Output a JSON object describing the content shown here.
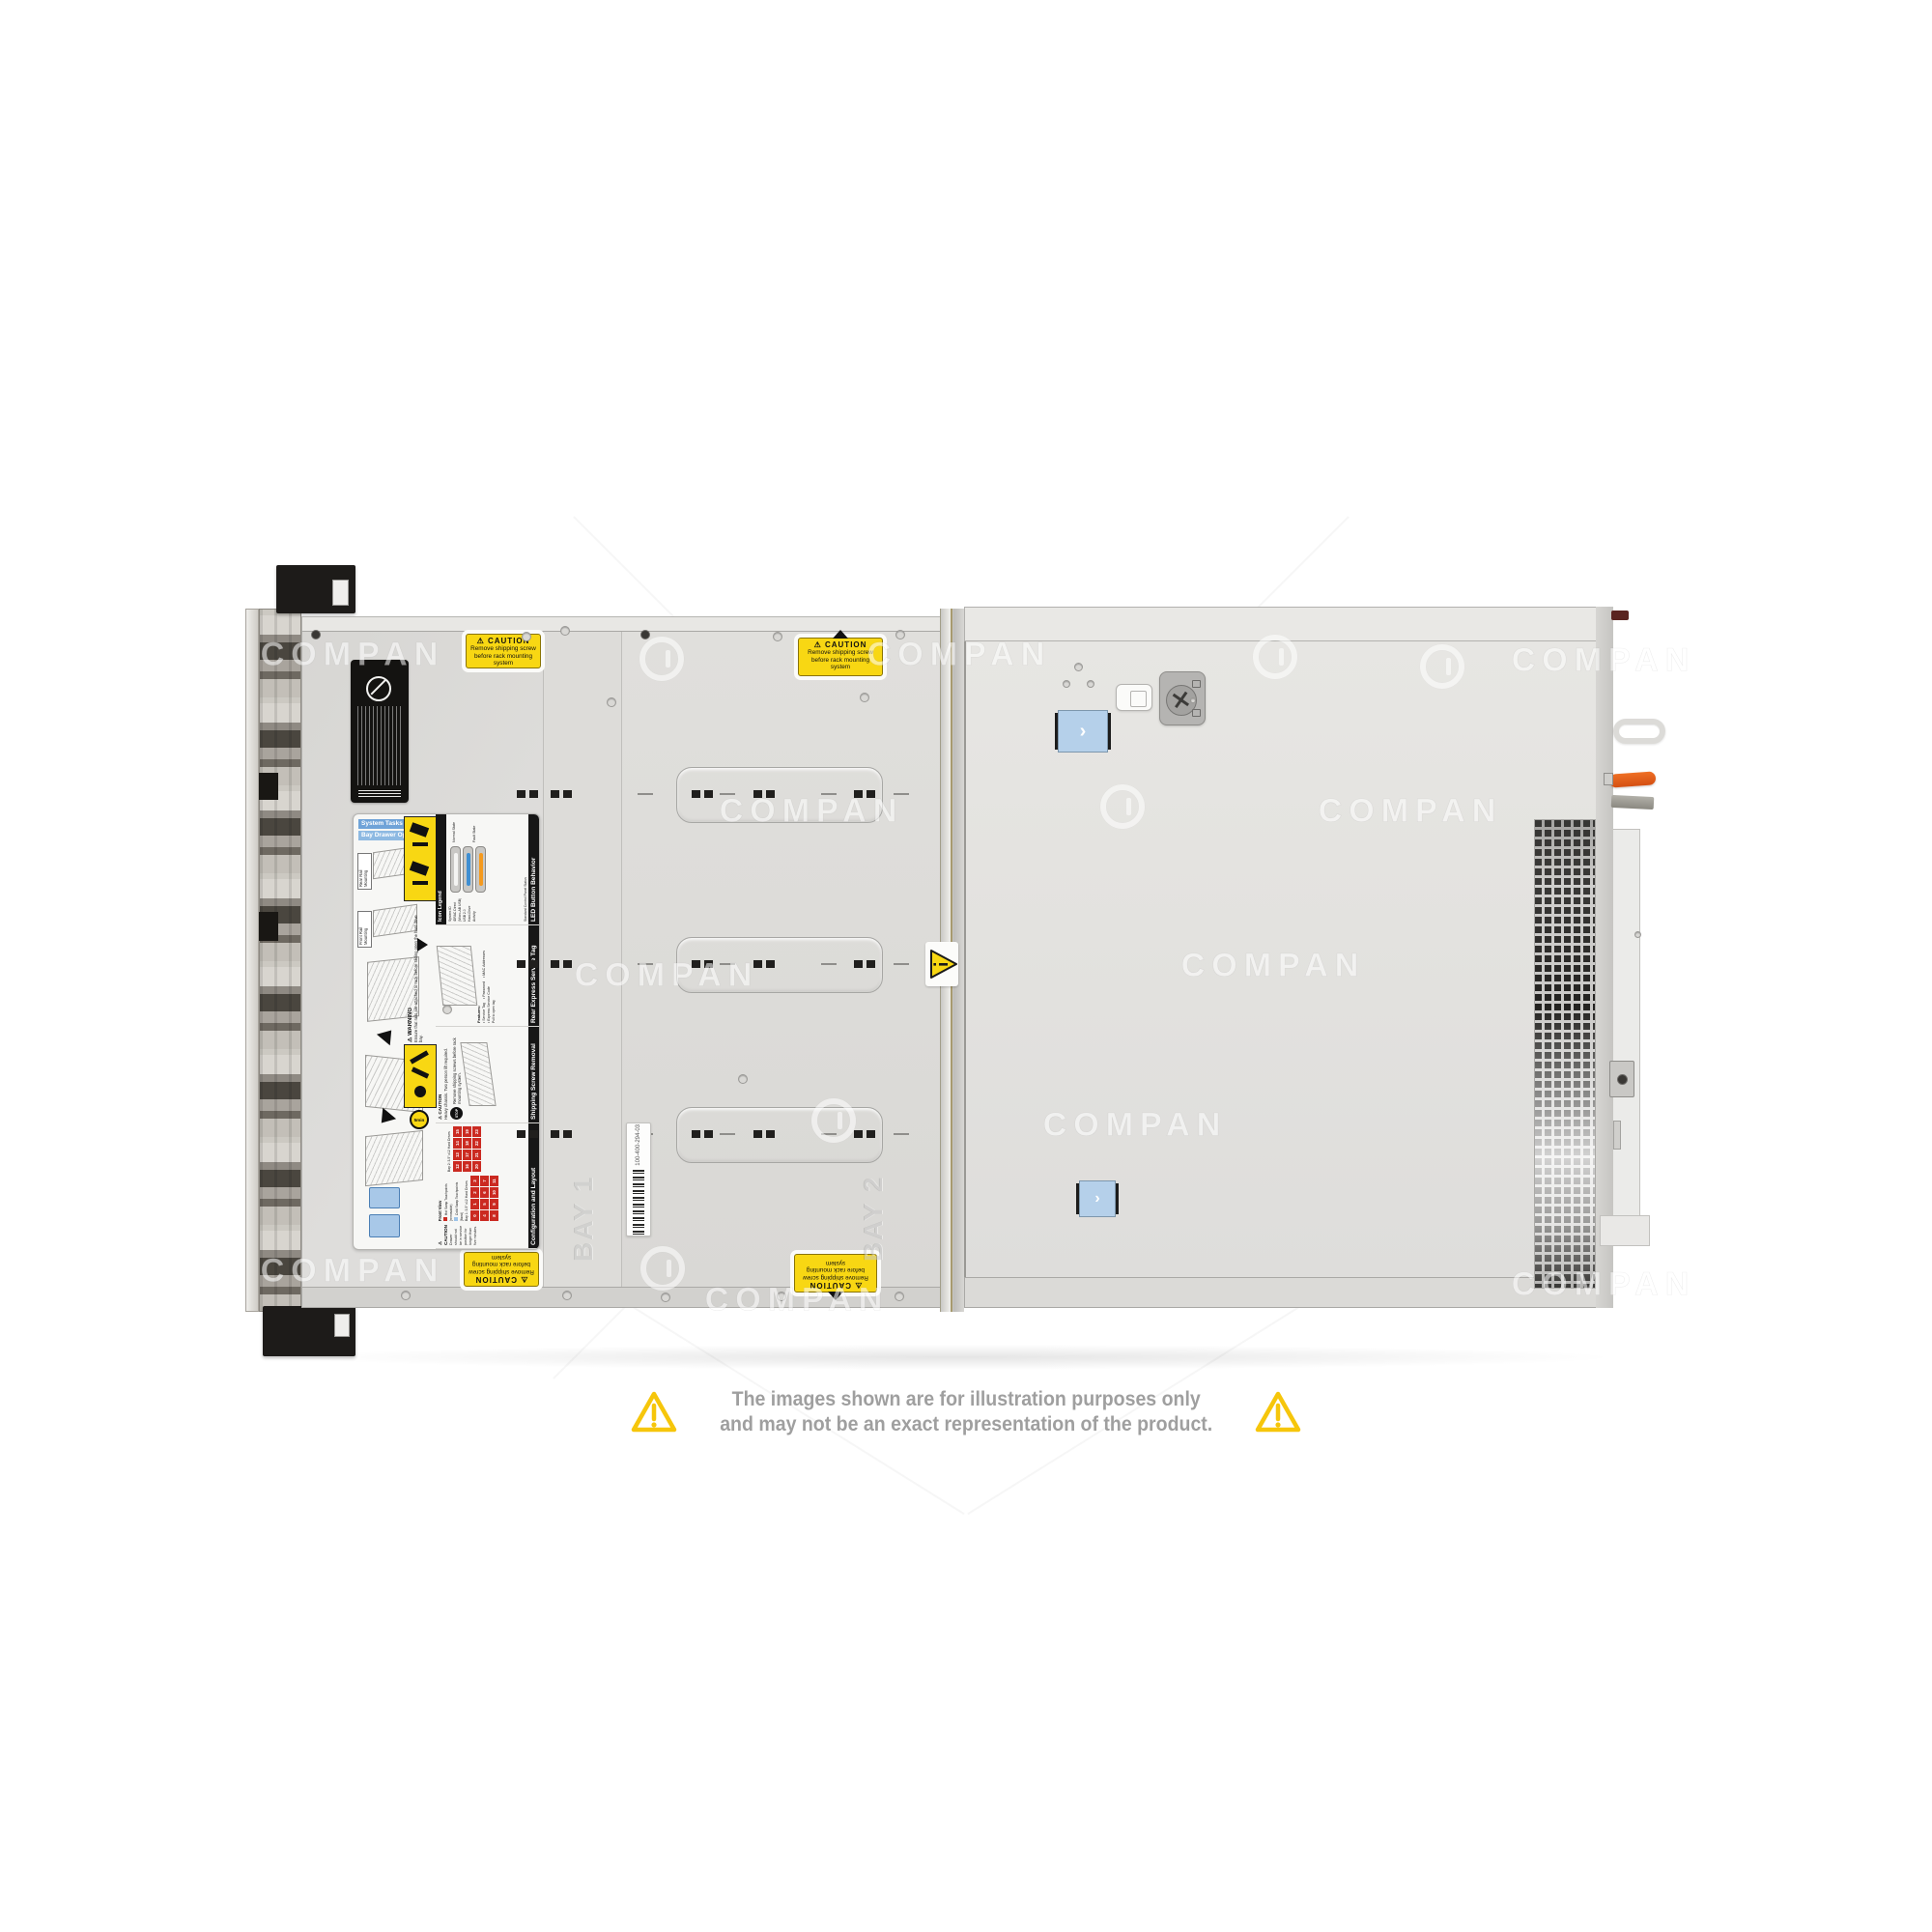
{
  "watermark": {
    "text": "COMPAN"
  },
  "disclaimer": {
    "line1": "The images shown are for illustration purposes only",
    "line2": "and may not be an exact representation of the product."
  },
  "server": {
    "caution_sticker": {
      "title": "CAUTION",
      "line1": "Remove shipping screw",
      "line2": "before rack mounting system"
    },
    "barcode_label": {
      "text": "100-400-294-03"
    },
    "embossed": {
      "bay1": "BAY 1",
      "bay2": "BAY 2"
    },
    "service_label": {
      "system_tasks": "System Tasks",
      "bay_drawer": "Bay Drawer Operation",
      "rear_rail": "Rear Rail Mounting",
      "front_rail": "Front Rail Mounting",
      "warning_header": "WARNING",
      "warning_text": "Ensure that rails are attached to rack before sliding open the hard drive bay.",
      "icon_legend": "Icon Legend",
      "icon_items": [
        "System ID",
        "iDRAC Direct (Micro-AB USB)",
        "USB 2.0",
        "Hard-Drive Activity"
      ],
      "led_header": "LED Button Behavior",
      "led_sub": "Standard Control Panel Status",
      "led_normal": "Normal State",
      "led_fault": "Fault State",
      "rear_tag_header": "Rear Express Service Tag",
      "rear_tag_features_title": "Features:",
      "rear_tag_features": [
        "Service Tag",
        "Password",
        "MAC Addresses",
        "Express Service Code"
      ],
      "rear_tag_note": "Pull to open tag",
      "shipping_header": "Shipping Screw Removal",
      "shipping_stop": "STOP",
      "shipping_text": "Remove shipping screws before rack mounting system.",
      "caution_heavy_header": "CAUTION",
      "caution_heavy_text": "Heavy chassis. Two person lift required.",
      "timer_text": "5min",
      "caution_drawer_header": "CAUTION",
      "caution_drawer_text": "Drawer should not be in service position for longer than five minutes.",
      "config_header": "Configuration and Layout",
      "front_view": "Front View",
      "hot_swap": "Hot Swap Touchpoints (removable)",
      "cold_swap": "Cold Swap Touchpoints (fixed)",
      "bay1_title": "Bay 1: 3.5\" x12 Hard Drives",
      "bay2_title": "Bay 2: 3.5\" x12 Hard Drives",
      "bay1_numbers": [
        0,
        1,
        2,
        3,
        4,
        5,
        6,
        7,
        8,
        9,
        10,
        11
      ],
      "bay2_numbers": [
        12,
        13,
        14,
        15,
        16,
        17,
        18,
        19,
        20,
        21,
        22,
        23
      ],
      "side_notes": [
        "System ID/Status Light Bar",
        "iDRAC Direct (Micro-AB USB)",
        "USB",
        "Power",
        "Hard Drive Activity"
      ]
    }
  },
  "colors": {
    "caution_yellow": "#f8d713",
    "accent_blue": "#b5d0ea",
    "bay_red": "#cb2a21",
    "lever_orange": "#e25b17",
    "disclaimer_yellow": "#f6c60b"
  }
}
